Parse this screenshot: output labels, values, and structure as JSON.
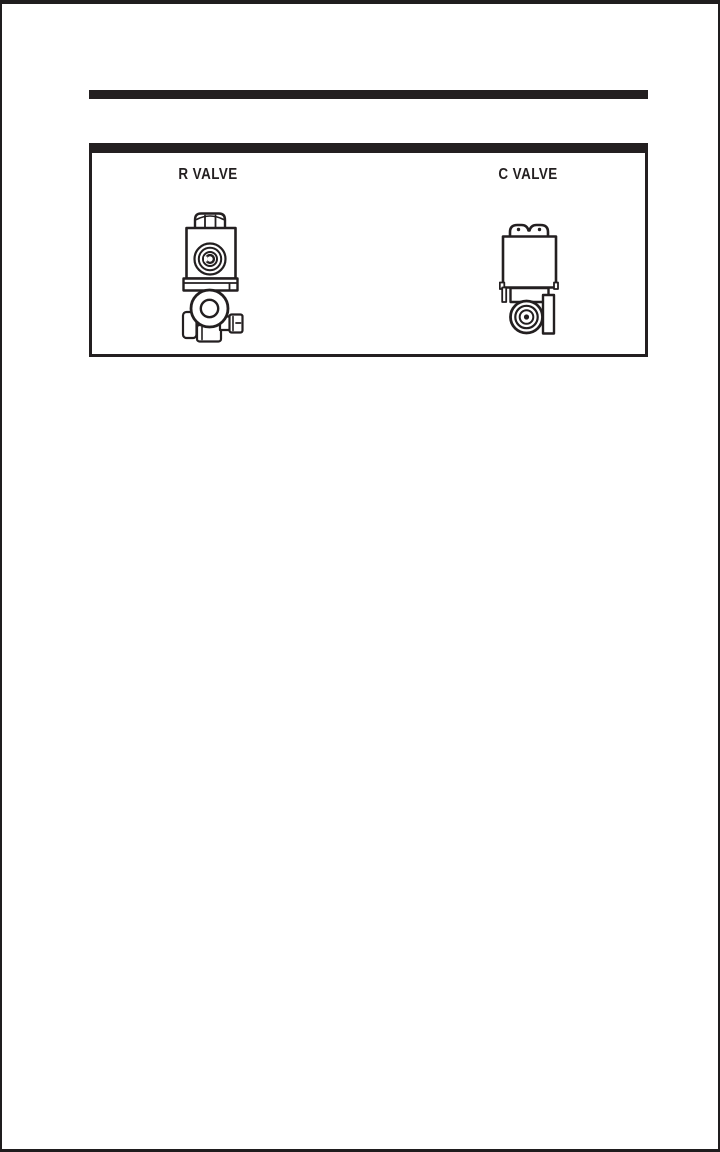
{
  "page": {
    "background": "#ffffff",
    "ink": "#231f20"
  },
  "panel": {
    "figures": [
      {
        "label": "R VALVE",
        "drawing": "r-valve-technical-drawing"
      },
      {
        "label": "C VALVE",
        "drawing": "c-valve-technical-drawing"
      }
    ]
  }
}
